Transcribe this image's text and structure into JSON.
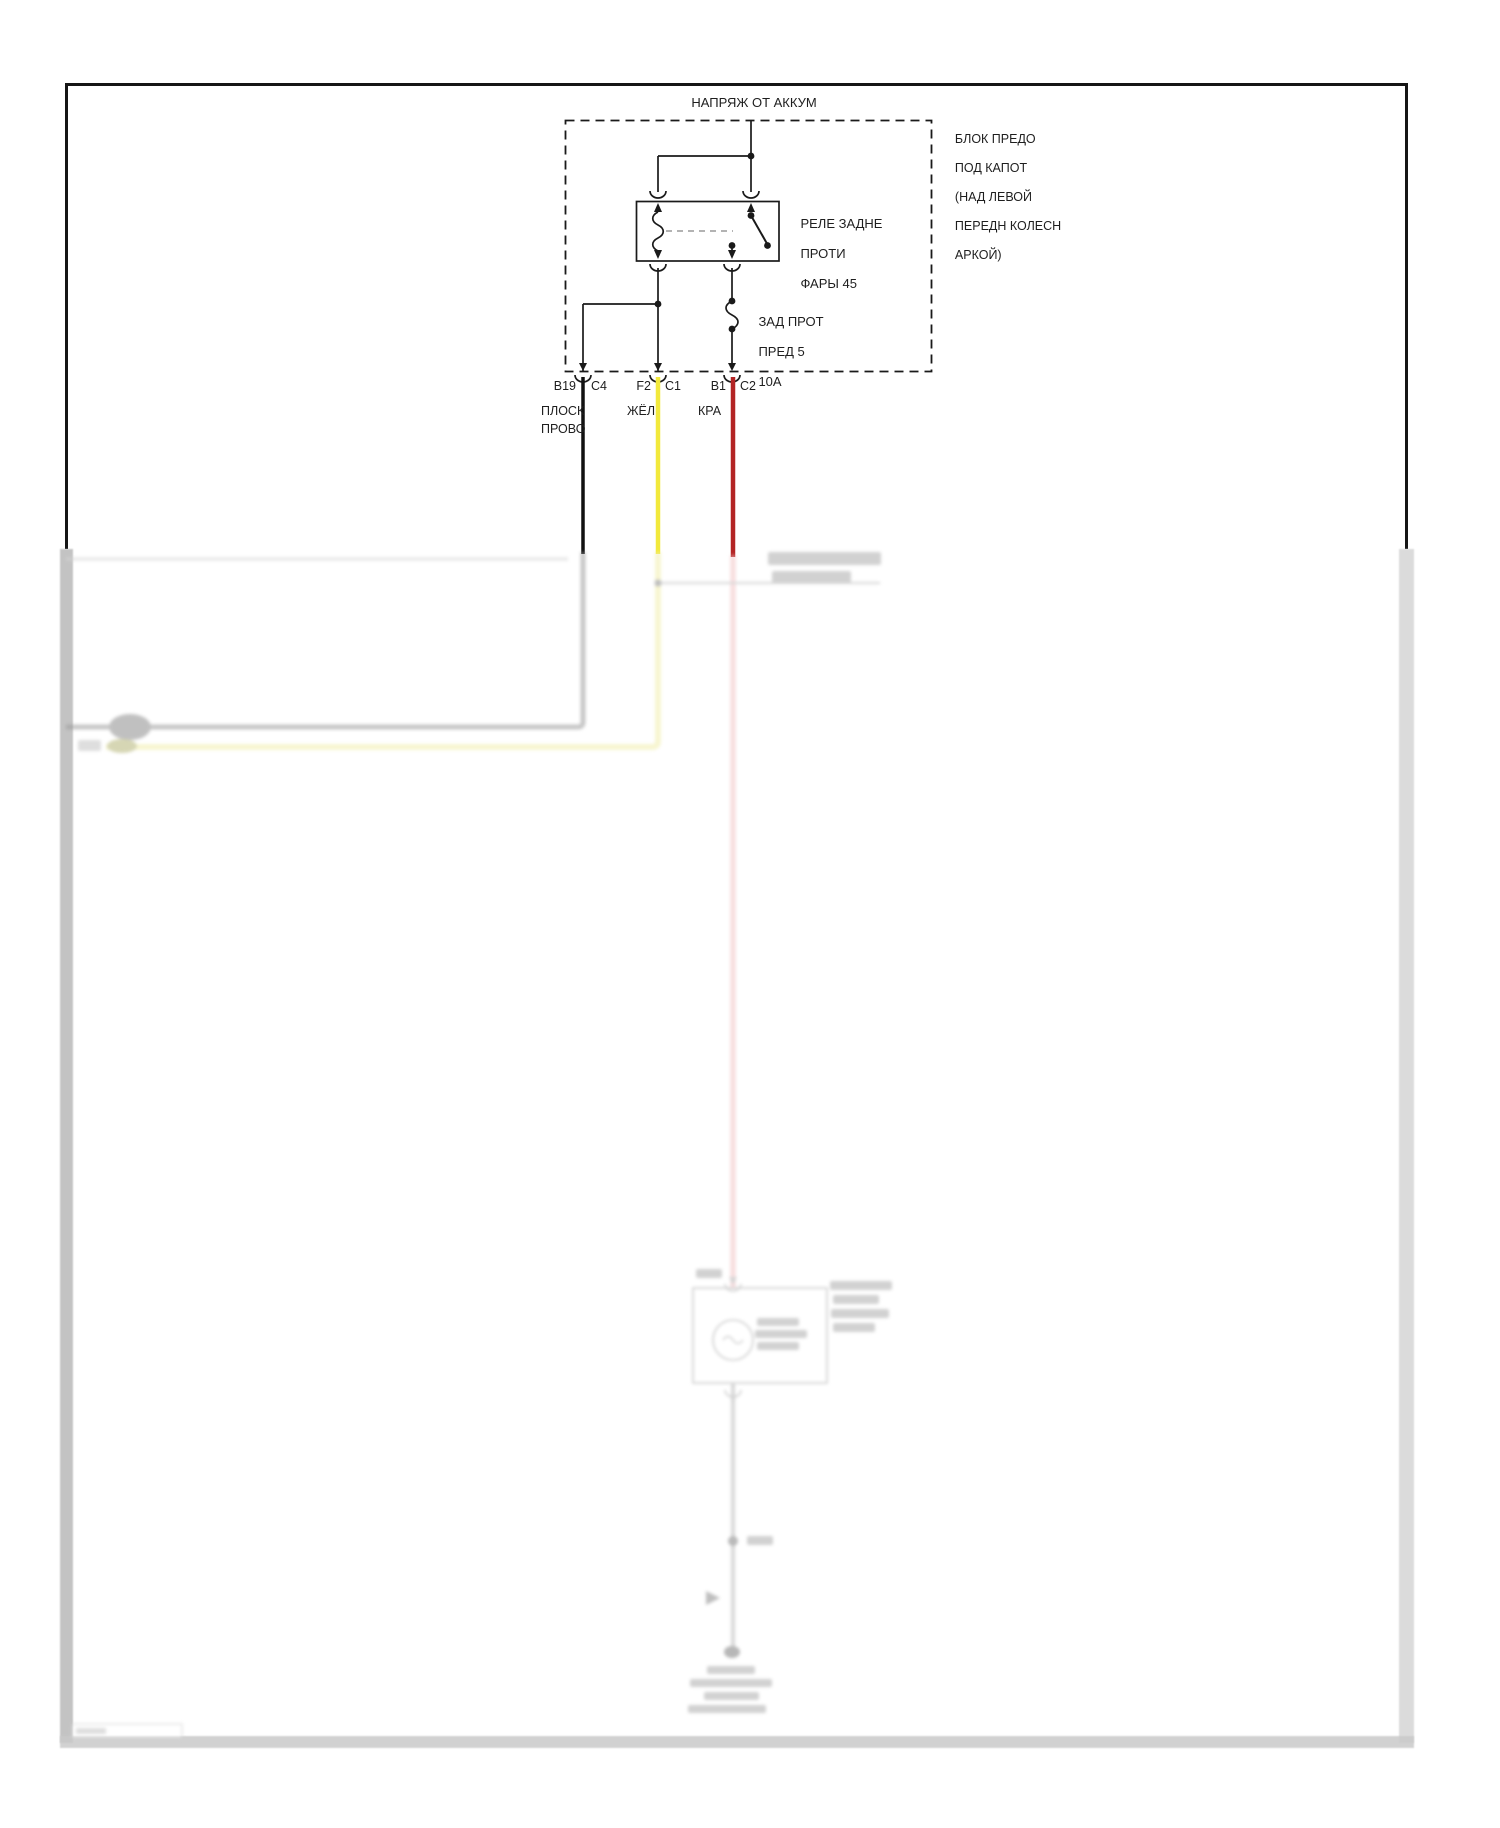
{
  "diagram": {
    "source_label": "НАПРЯЖ ОТ АККУМ",
    "fuse_block": {
      "label_lines": [
        "БЛОК ПРЕДО",
        "ПОД КАПОТ",
        "(НАД ЛЕВОЙ",
        "ПЕРЕДН КОЛЕСН",
        "АРКОЙ)"
      ]
    },
    "relay": {
      "label_lines": [
        "РЕЛЕ ЗАДНЕ",
        "ПРОТИ",
        "ФАРЫ 45"
      ]
    },
    "fuse": {
      "label_lines": [
        "ЗАД ПРОТ",
        "ПРЕД 5",
        "10А"
      ]
    },
    "connector_pins": [
      {
        "pin": "B19",
        "connector": "C4",
        "wire_label_lines": [
          "ПЛОСК",
          "ПРОВО"
        ],
        "wire_color_name": "black"
      },
      {
        "pin": "F2",
        "connector": "C1",
        "wire_label_lines": [
          "ЖЁЛ"
        ],
        "wire_color_name": "yellow"
      },
      {
        "pin": "B1",
        "connector": "C2",
        "wire_label_lines": [
          "КРА"
        ],
        "wire_color_name": "red"
      }
    ],
    "colors": {
      "wire_black": "#111111",
      "wire_yellow": "#f2e93c",
      "wire_red": "#b32424",
      "wire_grey_faded": "#9a9a9a",
      "wire_yellow_faded": "#f1eeab",
      "wire_red_faded": "#f2c3c5"
    }
  }
}
